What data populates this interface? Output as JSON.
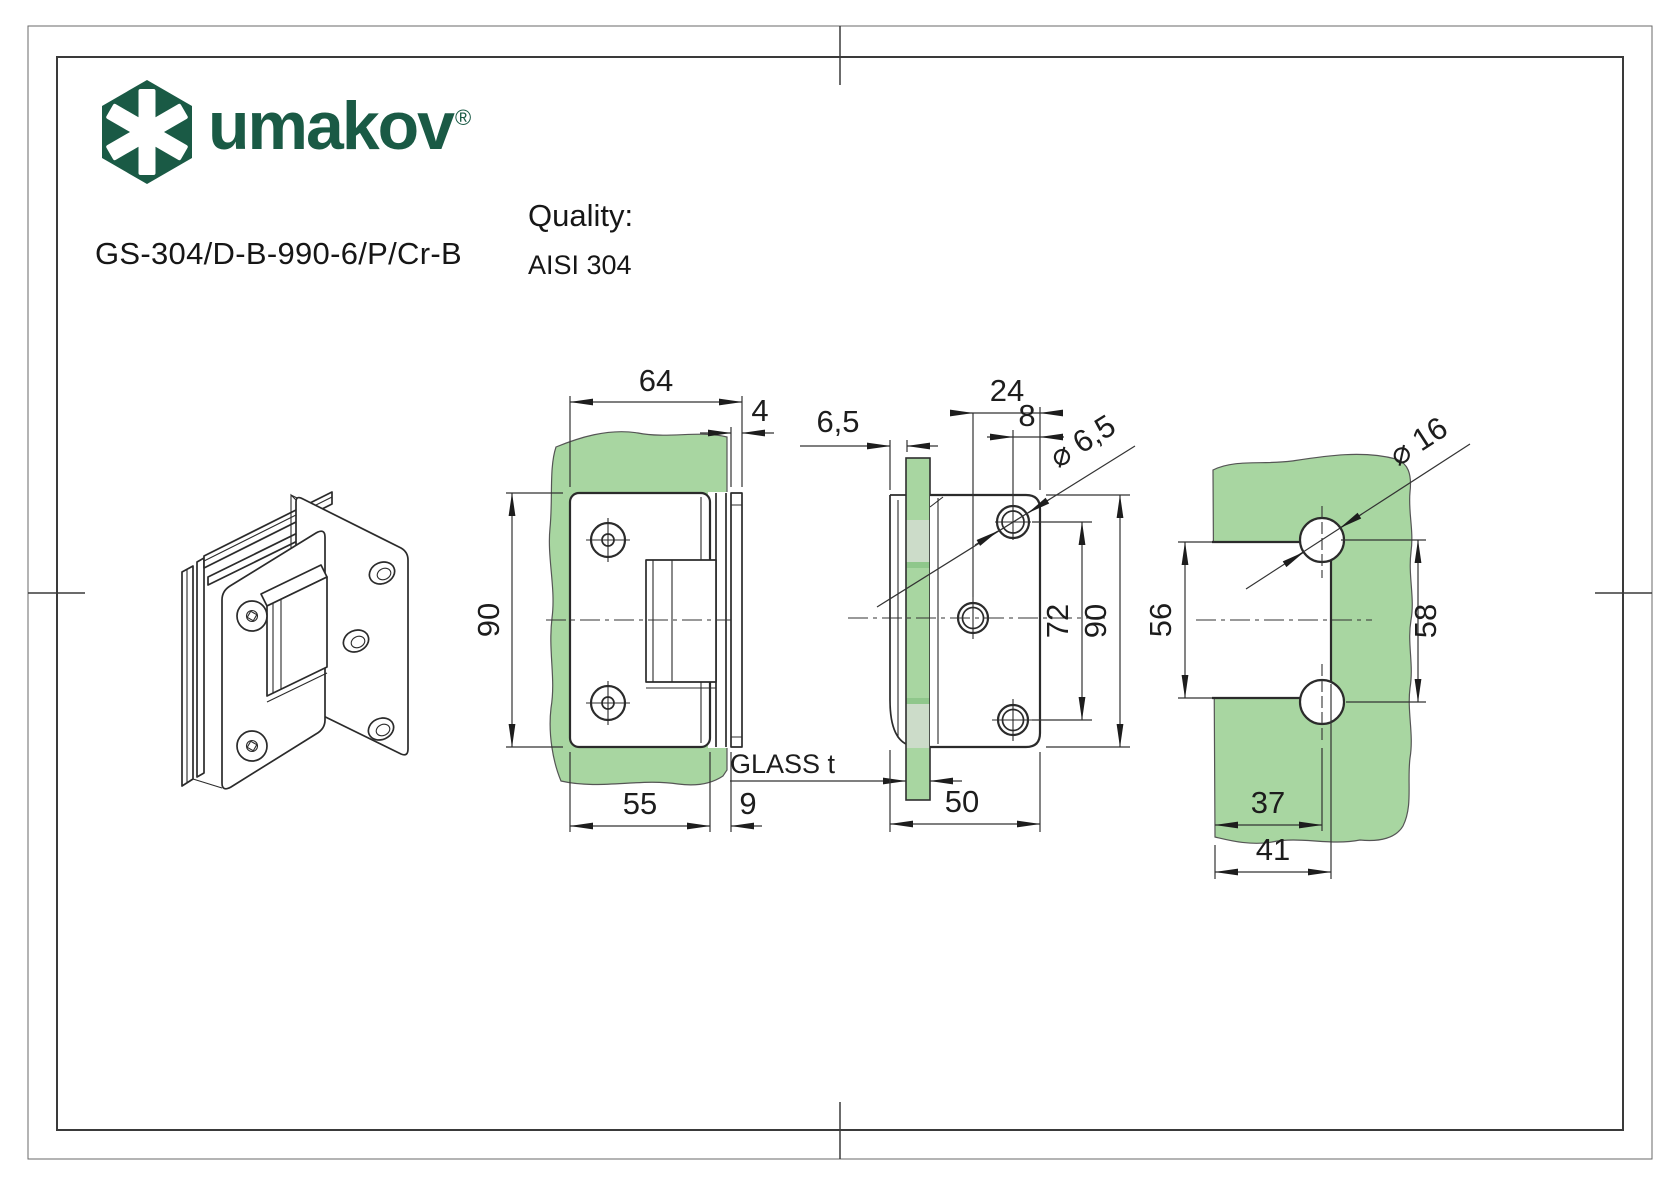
{
  "sheet": {
    "background": "#ffffff",
    "frame_color": "#3a3a3a"
  },
  "brand": {
    "name": "umakov",
    "registered": "®",
    "color": "#1a5a45"
  },
  "product": {
    "code": "GS-304/D-B-990-6/P/Cr-B"
  },
  "quality": {
    "label": "Quality:",
    "value": "AISI 304"
  },
  "drawing": {
    "glass_color": "#a8d6a1",
    "glass_gasket_color": "#ccdcc9",
    "glass_dark_color": "#8fc78b",
    "line_color": "#2b2b2b",
    "front_view": {
      "width": "64",
      "wall_plate_thickness": "4",
      "height": "90",
      "plate_width": "55",
      "offset": "9"
    },
    "side_view": {
      "lip": "6,5",
      "hole_x": "24",
      "hole_x2": "8",
      "hole_dia": "⌀ 6,5",
      "hole_span": "72",
      "height": "90",
      "glass_label": "GLASS t",
      "depth": "50"
    },
    "glass_view": {
      "hole_dia": "⌀ 16",
      "cutout_height": "56",
      "hole_span": "58",
      "hole_center_x": "37",
      "cutout_depth": "41"
    }
  }
}
